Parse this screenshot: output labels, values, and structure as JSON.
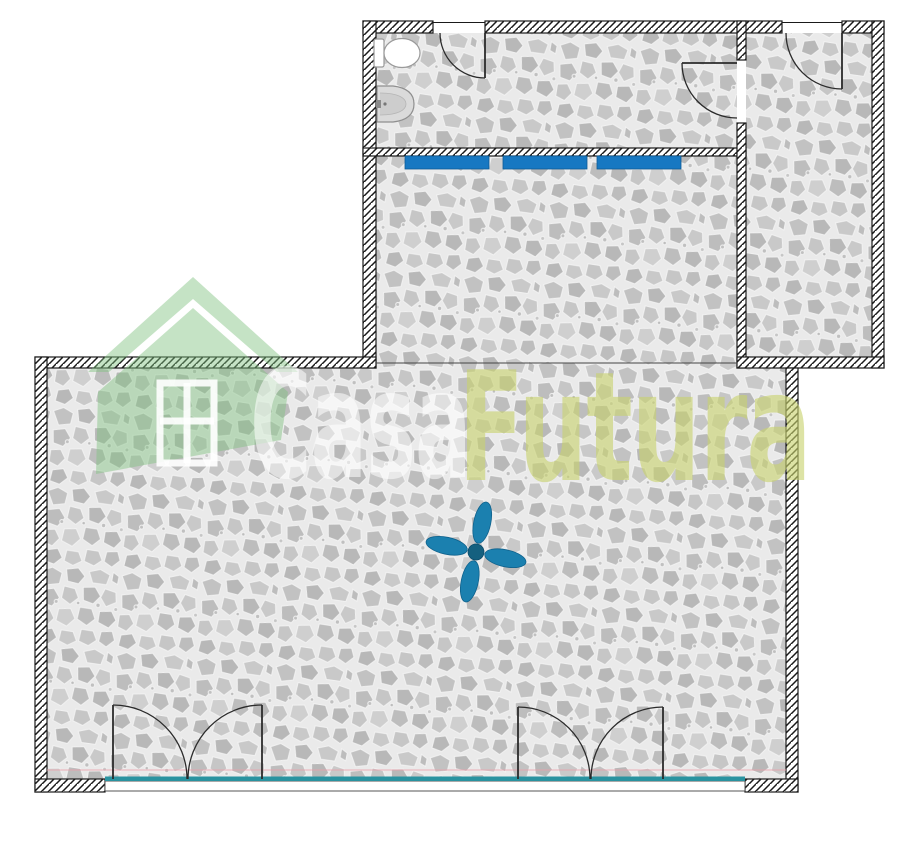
{
  "watermark": {
    "brand_part1": "Casa",
    "brand_part2": "Futura",
    "logo": "house-roof-logo"
  },
  "colors": {
    "wall_line": "#1a1a1a",
    "floor_base": "#eaeaea",
    "stone_gray": "#c2c2c2",
    "unit_blue": "#1778c2",
    "unit_blue_edge": "#0e5a94",
    "fan_teal": "#1b80af",
    "fan_hub": "#15607f",
    "glass_teal": "#2a93a0",
    "accent_pink": "rgba(235,160,170,0.65)",
    "watermark_green": "rgba(126,193,126,0.45)",
    "watermark_text_yellow": "rgba(200,210,110,0.62)",
    "watermark_text_white": "rgba(255,255,255,0.55)",
    "fixture_outline": "#8f8f8f"
  },
  "symbols": {
    "ceiling_fan": "ceiling-fan",
    "toilet": "toilet",
    "sink": "washbasin",
    "wall_unit_count": 3,
    "double_french_doors": 2,
    "swing_doors": 3
  }
}
